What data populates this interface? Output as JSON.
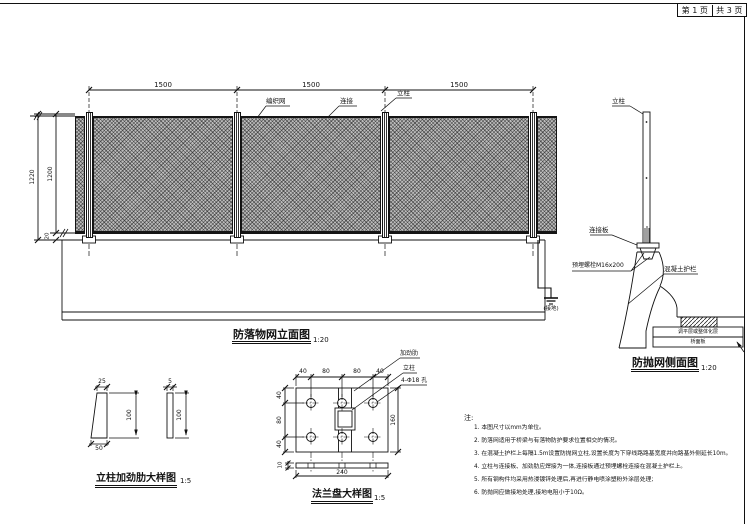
{
  "page_box": {
    "current": "第 1 页",
    "total": "共 3 页"
  },
  "elevation": {
    "title": "防落物网立面图",
    "scale": "1:20",
    "dims_top": [
      "1500",
      "1500",
      "1500"
    ],
    "dim_outer": "1220",
    "dim_inner": "1200",
    "dim_gap": "20",
    "label_mesh": "编织网",
    "label_connect": "连接",
    "label_post": "立柱",
    "label_ground": "(接地)"
  },
  "side": {
    "title": "防抛网侧面图",
    "scale": "1:20",
    "label_post": "立柱",
    "label_plate": "连接板",
    "label_bolt": "预埋螺栓M16x200",
    "label_barrier": "混凝土护栏",
    "label_layer1": "调平层或整体化层",
    "label_layer2": "桥面板"
  },
  "stiffener": {
    "title": "立柱加劲肋大样图",
    "scale": "1:5",
    "dim_top_width": "25",
    "dim_thickness": "5",
    "dim_height1": "100",
    "dim_height2": "100",
    "dim_bottom_width": "50"
  },
  "flange": {
    "title": "法兰盘大样图",
    "scale": "1:5",
    "label_rib": "加劲肋",
    "label_post": "立柱",
    "label_holes": "4-Φ18 孔",
    "dims_top": [
      "40",
      "80",
      "80",
      "40"
    ],
    "dims_left": [
      "40",
      "80",
      "40"
    ],
    "dim_right": "160",
    "dim_bottom": "240",
    "dim_thickness": "10"
  },
  "notes": {
    "heading": "注:",
    "items": [
      "1. 本图尺寸以mm为单位。",
      "2. 防落网适用于桥梁与有落物防护要求位置相交的情况。",
      "3. 在混凝土护栏上每隔1.5m设置防抛网立柱,设置长度为下穿线路路基宽度并向路基外侧延长10m。",
      "4. 立柱与连接板、加劲肋应焊接为一体,连接板通过预埋螺栓连接在混凝土护栏上。",
      "5. 所有钢构件均采用热浸镀锌处理后,再进行静电喷涂塑粉外涂层处理;",
      "6. 防抛网应做接地处理,接地电阻小于10Ω。"
    ]
  }
}
